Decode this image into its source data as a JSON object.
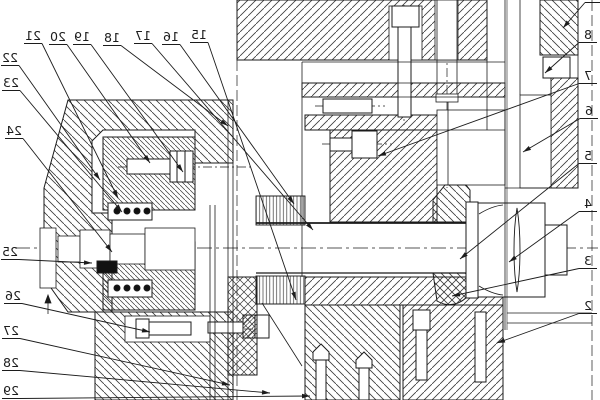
{
  "drawing": {
    "colors": {
      "background": "#ffffff",
      "line": "#1c1c1c",
      "hatch": "#3a3a3a"
    },
    "mirrored_text": true,
    "callouts": [
      {
        "label": "21",
        "x": 33,
        "y": 40,
        "ex": 118,
        "ey": 198,
        "side": "top"
      },
      {
        "label": "20",
        "x": 58,
        "y": 41,
        "ex": 150,
        "ey": 163,
        "side": "top"
      },
      {
        "label": "19",
        "x": 82,
        "y": 41,
        "ex": 183,
        "ey": 172,
        "side": "top"
      },
      {
        "label": "18",
        "x": 112,
        "y": 42,
        "ex": 228,
        "ey": 126,
        "side": "top"
      },
      {
        "label": "17",
        "x": 143,
        "y": 40,
        "ex": 313,
        "ey": 230,
        "side": "top"
      },
      {
        "label": "16",
        "x": 171,
        "y": 41,
        "ex": 294,
        "ey": 204,
        "side": "top"
      },
      {
        "label": "15",
        "x": 199,
        "y": 39,
        "ex": 296,
        "ey": 300,
        "side": "top"
      },
      {
        "label": "22",
        "x": 10,
        "y": 62,
        "ex": 100,
        "ey": 180,
        "side": "left"
      },
      {
        "label": "23",
        "x": 11,
        "y": 87,
        "ex": 122,
        "ey": 212,
        "side": "left"
      },
      {
        "label": "24",
        "x": 14,
        "y": 135,
        "ex": 112,
        "ey": 252,
        "side": "left"
      },
      {
        "label": "25",
        "x": 10,
        "y": 256,
        "ex": 92,
        "ey": 263,
        "side": "left"
      },
      {
        "label": "26",
        "x": 13,
        "y": 300,
        "ex": 150,
        "ey": 332,
        "side": "left"
      },
      {
        "label": "27",
        "x": 11,
        "y": 335,
        "ex": 230,
        "ey": 385,
        "side": "left"
      },
      {
        "label": "28",
        "x": 11,
        "y": 367,
        "ex": 270,
        "ey": 393,
        "side": "left"
      },
      {
        "label": "29",
        "x": 11,
        "y": 395,
        "ex": 310,
        "ey": 396,
        "side": "left"
      },
      {
        "label": "9",
        "x": 594,
        "y": -1,
        "ex": 563,
        "ey": 28,
        "side": "right"
      },
      {
        "label": "8",
        "x": 588,
        "y": 39,
        "ex": 545,
        "ey": 73,
        "side": "right"
      },
      {
        "label": "7",
        "x": 588,
        "y": 80,
        "ex": 378,
        "ey": 156,
        "side": "right"
      },
      {
        "label": "6",
        "x": 589,
        "y": 115,
        "ex": 523,
        "ey": 152,
        "side": "right"
      },
      {
        "label": "5",
        "x": 588,
        "y": 160,
        "ex": 460,
        "ey": 259,
        "side": "right"
      },
      {
        "label": "4",
        "x": 588,
        "y": 208,
        "ex": 509,
        "ey": 262,
        "side": "right"
      },
      {
        "label": "3",
        "x": 588,
        "y": 265,
        "ex": 452,
        "ey": 296,
        "side": "right"
      },
      {
        "label": "2",
        "x": 588,
        "y": 310,
        "ex": 497,
        "ey": 343,
        "side": "right"
      }
    ]
  }
}
